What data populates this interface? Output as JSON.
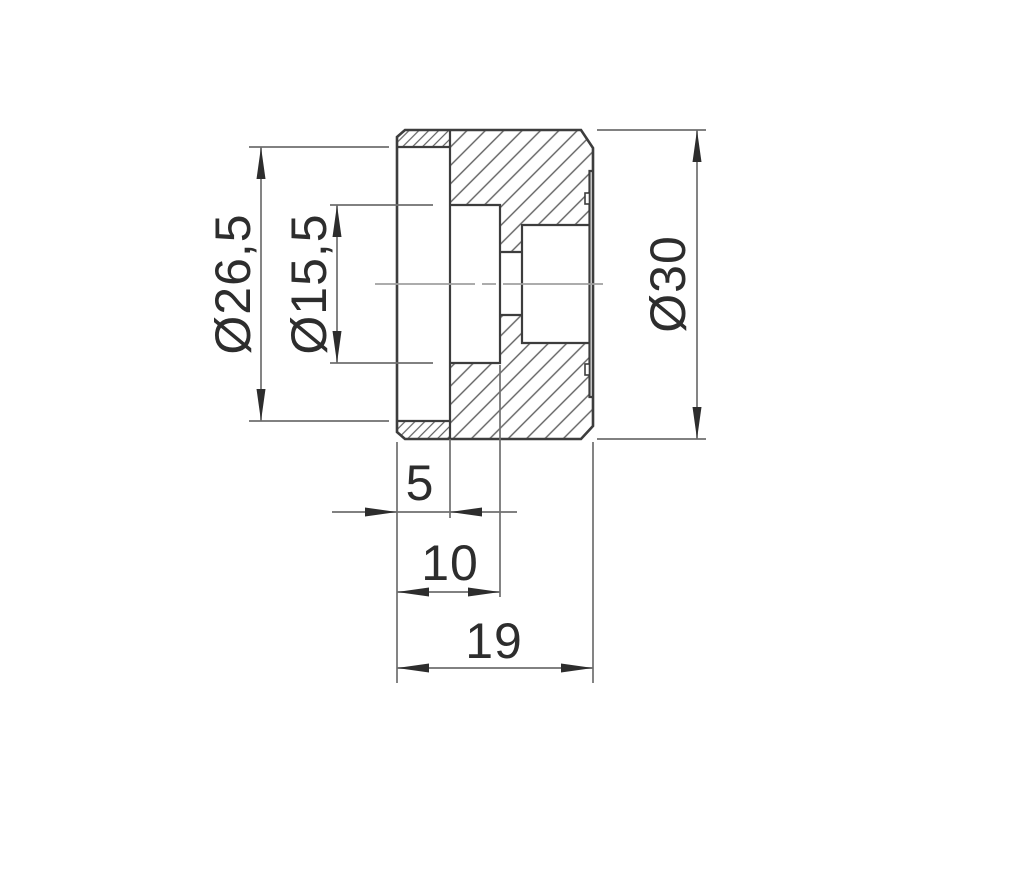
{
  "drawing": {
    "labels": {
      "flange_diameter": "Ø26,5",
      "hub_diameter": "Ø15,5",
      "outer_diameter": "Ø30",
      "flange_width": "5",
      "hub_length": "10",
      "overall_length": "19"
    },
    "colors": {
      "background": "#ffffff",
      "outline": "#3d3d3d",
      "hatch": "#606060",
      "dimension": "#6f6f6f",
      "centerline": "#a0a0a0",
      "text": "#2d2d2d"
    }
  }
}
